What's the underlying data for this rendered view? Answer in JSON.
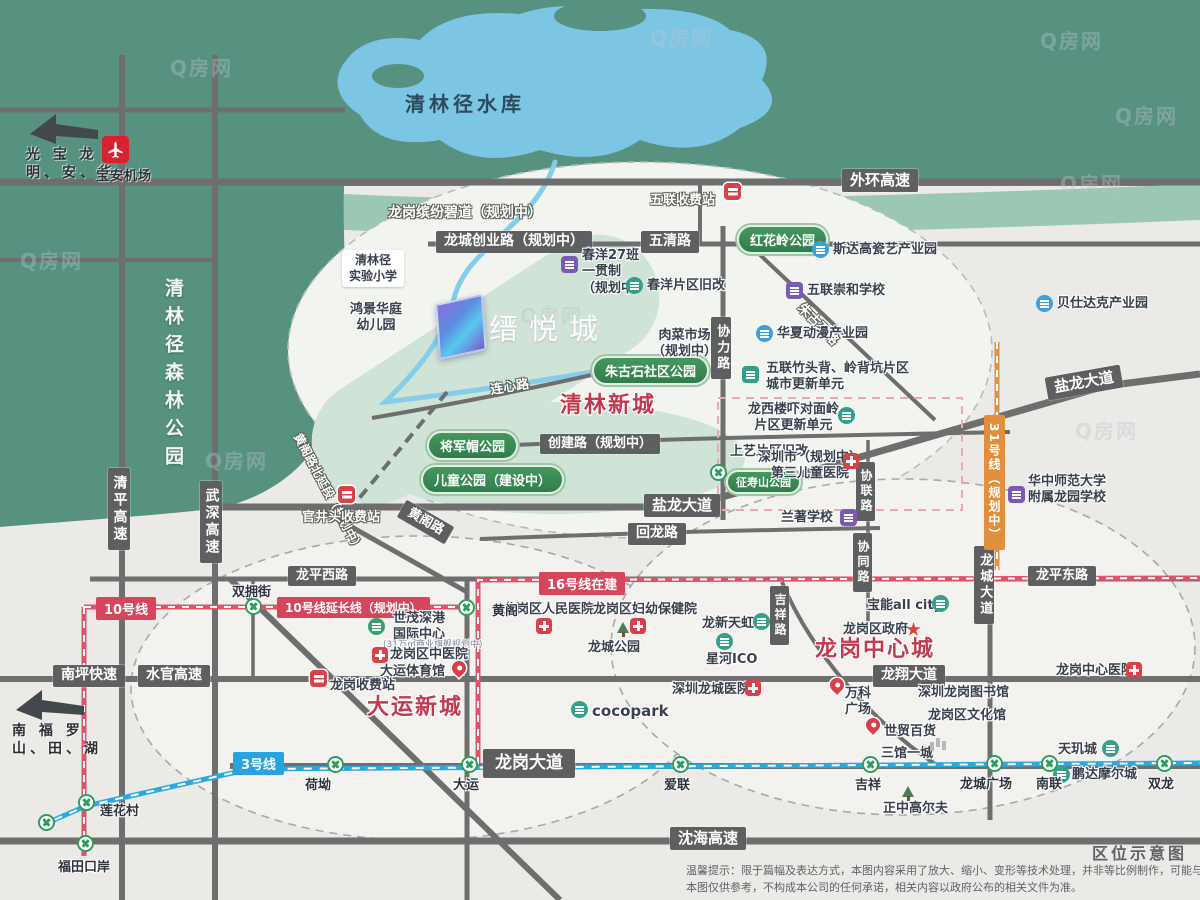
{
  "watermark": "Q房网",
  "project": {
    "name": "缙悦城"
  },
  "corner": {
    "title": "区位示意图",
    "disclaimer1": "温馨提示：限于篇幅及表达方式，本图内容采用了放大、缩小、变形等技术处理，并非等比例制作，可能与实际情况存在差异。",
    "disclaimer2": "本图仅供参考，不构成本公司的任何承诺，相关内容以政府公布的相关文件为准。"
  },
  "compass_nw": {
    "line1": "光  宝  龙",
    "line2": "明、安、华",
    "airport": "宝安机场"
  },
  "compass_sw": {
    "line1": "南  福  罗",
    "line2": "山、田、湖"
  },
  "geo": {
    "reservoir": "清林径水库",
    "forest": "清林径森林公园"
  },
  "districts": [
    "清林新城",
    "大运新城",
    "龙岗中心城"
  ],
  "roads": [
    "外环高速",
    "龙城创业路（规划中）",
    "五清路",
    "创建路（规划中）",
    "回龙路",
    "盐龙大道",
    "龙平西路",
    "龙平东路",
    "龙翔大道",
    "龙岗大道",
    "沈海高速",
    "南坪快速",
    "水官高速",
    "清平高速",
    "武深高速",
    "协力路",
    "协联路",
    "协同路",
    "吉祥路",
    "龙城大道",
    "黄阁路",
    "黄阁路北延段（规划中）",
    "朱古石路",
    "连心路",
    "龙岗缤纷碧道（规划中）"
  ],
  "metro": {
    "l3_badge": "3号线",
    "l10_badge": "10号线",
    "l10_ext": "10号线延长线（规划中）",
    "l16_badge": "16号线在建",
    "l31_badge": "31号线（规划中）",
    "stations": [
      "双拥街",
      "黄阁",
      "荷坳",
      "大运",
      "爱联",
      "吉祥",
      "龙城广场",
      "南联",
      "双龙",
      "莲花村",
      "福田口岸"
    ]
  },
  "tolls": [
    "五联收费站",
    "官井头收费站",
    "龙岗收费站"
  ],
  "parks": [
    "红花岭公园",
    "朱古石社区公园",
    "将军帽公园",
    "儿童公园（建设中）",
    "征寿山公园"
  ],
  "pois": [
    "清林径\n实验小学",
    "鸿景华庭\n幼儿园",
    "春洋27班\n一贯制\n（规划中）",
    "春洋片区旧改",
    "五联崇和学校",
    "斯达高瓷艺产业园",
    "贝仕达克产业园",
    "华夏动漫产业园",
    "肉菜市场\n（规划中）",
    "五联竹头背、岭背坑片区\n城市更新单元",
    "龙西楼吓对面岭\n片区更新单元",
    "上艺片区旧改",
    "深圳市（规划中）\n第三儿童医院",
    "兰著学校",
    "华中师范大学\n附属龙园学校",
    "世茂深港\n国际中心",
    "(31万㎡商业旗舰规划中)",
    "龙岗区中医院",
    "大运体育馆",
    "龙岗区人民医院",
    "龙岗区妇幼保健院",
    "龙城公园",
    "龙新天虹",
    "星河ICO",
    "宝能all city",
    "龙岗区政府",
    "万科\n广场",
    "深圳龙城医院",
    "深圳龙岗图书馆",
    "龙岗区文化馆",
    "世贸百货",
    "三馆一城",
    "天玑城",
    "鹏达摩尔城",
    "正中高尔夫",
    "龙岗中心医院",
    "cocopark"
  ]
}
